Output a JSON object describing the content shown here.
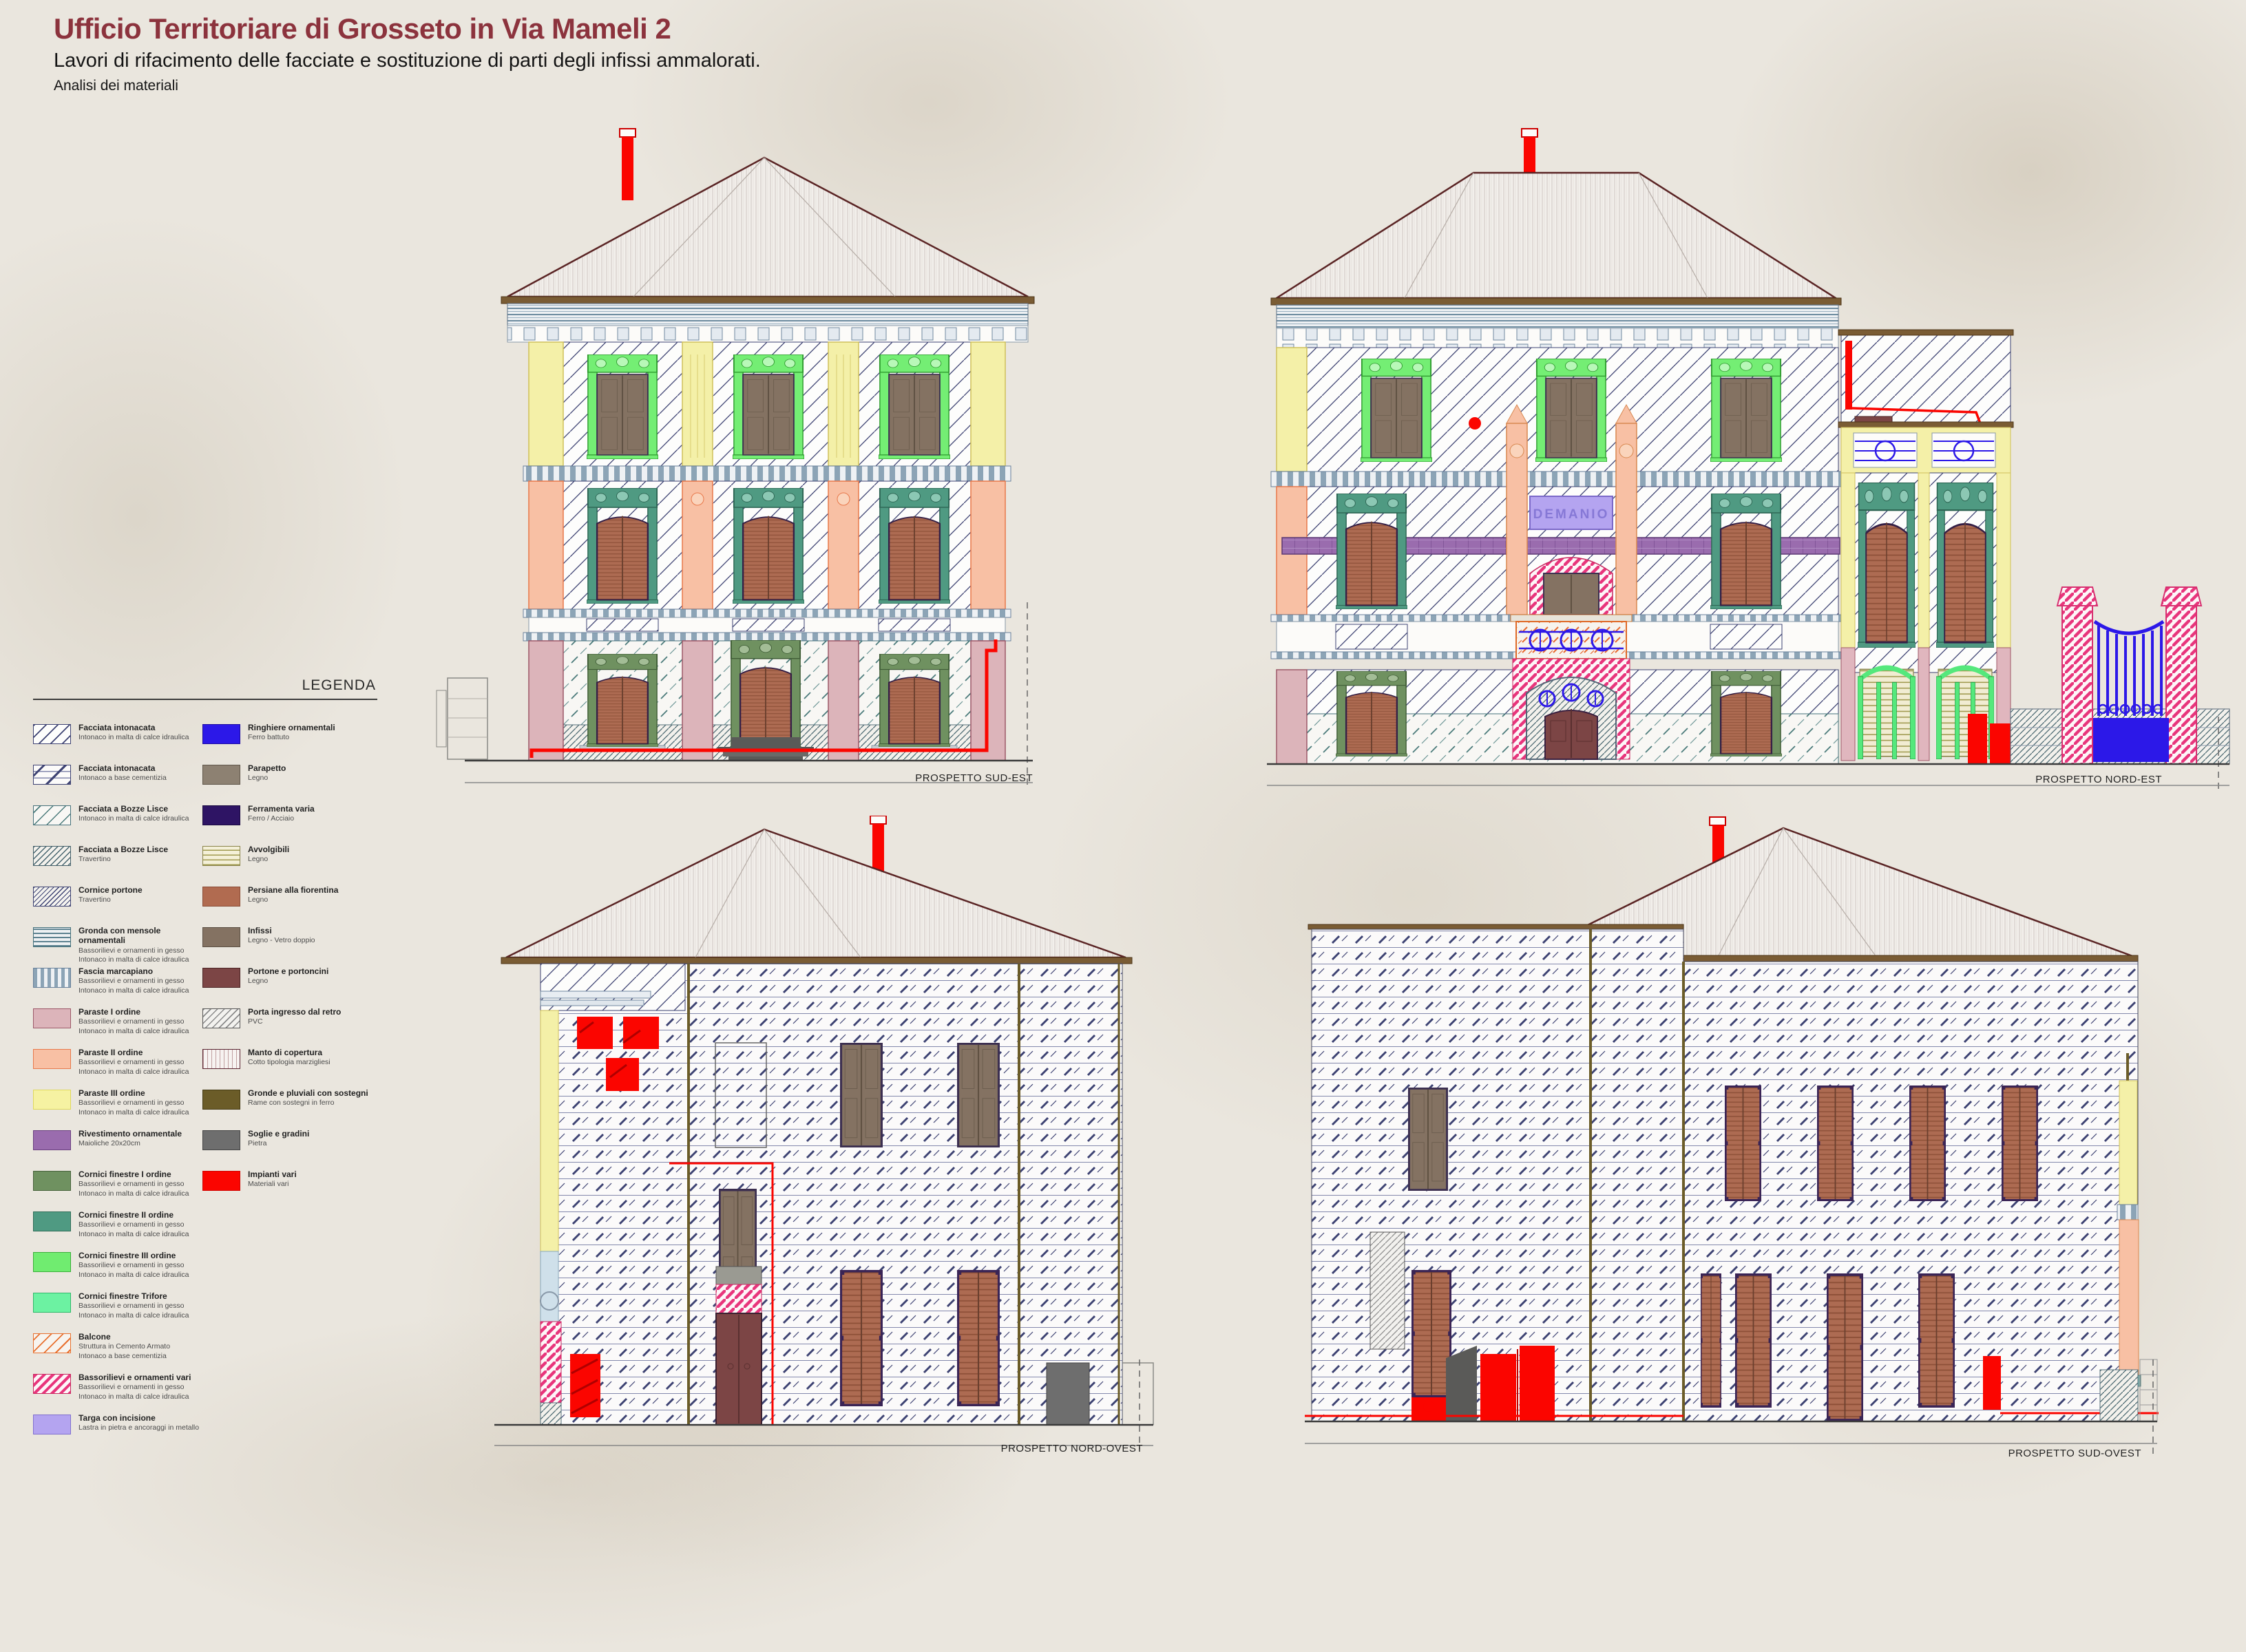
{
  "header": {
    "title": "Ufficio Territoriare di Grosseto in Via Mameli 2",
    "subtitle": "Lavori di rifacimento delle facciate e sostituzione di parti degli infissi ammalorati.",
    "note": "Analisi dei materiali"
  },
  "legend": {
    "title": "LEGENDA",
    "left": [
      {
        "title": "Facciata intonacata",
        "desc": "Intonaco in malta di calce idraulica",
        "swatch": "sw-hatch-calce"
      },
      {
        "title": "Facciata intonacata",
        "desc": "Intonaco a base cementizia",
        "swatch": "sw-hatch-cem"
      },
      {
        "title": "Facciata a Bozze Lisce",
        "desc": "Intonaco in malta di calce idraulica",
        "swatch": "sw-hatch-bozze"
      },
      {
        "title": "Facciata a Bozze Lisce",
        "desc": "Travertino",
        "swatch": "sw-hatch-trav"
      },
      {
        "title": "Cornice portone",
        "desc": "Travertino",
        "swatch": "sw-hatch-cornice"
      },
      {
        "title": "Gronda con mensole ornamentali",
        "desc": "Bassorilievi e ornamenti in gesso\nIntonaco in malta di calce idraulica",
        "swatch": "sw-gronda"
      },
      {
        "title": "Fascia marcapiano",
        "desc": "Bassorilievi e ornamenti in gesso\nIntonaco in malta di calce idraulica",
        "swatch": "sw-marcapiano"
      },
      {
        "title": "Paraste I ordine",
        "desc": "Bassorilievi e ornamenti in gesso\nIntonaco in malta di calce idraulica",
        "swatch": "sw-paraste1"
      },
      {
        "title": "Paraste II ordine",
        "desc": "Bassorilievi e ornamenti in gesso\nIntonaco in malta di calce idraulica",
        "swatch": "sw-paraste2"
      },
      {
        "title": "Paraste III ordine",
        "desc": "Bassorilievi e ornamenti in gesso\nIntonaco in malta di calce idraulica",
        "swatch": "sw-paraste3"
      },
      {
        "title": "Rivestimento ornamentale",
        "desc": "Maioliche 20x20cm",
        "swatch": "sw-maioliche"
      },
      {
        "title": "Cornici finestre I ordine",
        "desc": "Bassorilievi e ornamenti in gesso\nIntonaco in malta di calce idraulica",
        "swatch": "sw-corn1"
      },
      {
        "title": "Cornici finestre II ordine",
        "desc": "Bassorilievi e ornamenti in gesso\nIntonaco in malta di calce idraulica",
        "swatch": "sw-corn2"
      },
      {
        "title": "Cornici finestre III ordine",
        "desc": "Bassorilievi e ornamenti in gesso\nIntonaco in malta di calce idraulica",
        "swatch": "sw-corn3"
      },
      {
        "title": "Cornici finestre Trifore",
        "desc": "Bassorilievi e ornamenti in gesso\nIntonaco in malta di calce idraulica",
        "swatch": "sw-trifore"
      },
      {
        "title": "Balcone",
        "desc": "Struttura in Cemento Armato\nIntonaco a base cementizia",
        "swatch": "sw-balcone"
      },
      {
        "title": "Bassorilievi e ornamenti vari",
        "desc": "Bassorilievi e ornamenti in gesso\nIntonaco in malta di calce idraulica",
        "swatch": "sw-bassorilievi"
      },
      {
        "title": "Targa con incisione",
        "desc": "Lastra in pietra e ancoraggi in metallo",
        "swatch": "sw-targa"
      }
    ],
    "right": [
      {
        "title": "Ringhiere ornamentali",
        "desc": "Ferro battuto",
        "swatch": "sw-ringhiere"
      },
      {
        "title": "Parapetto",
        "desc": "Legno",
        "swatch": "sw-parapetto"
      },
      {
        "title": "Ferramenta varia",
        "desc": "Ferro / Acciaio",
        "swatch": "sw-ferramenta"
      },
      {
        "title": "Avvolgibili",
        "desc": "Legno",
        "swatch": "sw-avvolgibili"
      },
      {
        "title": "Persiane alla fiorentina",
        "desc": "Legno",
        "swatch": "sw-persiane"
      },
      {
        "title": "Infissi",
        "desc": "Legno - Vetro doppio",
        "swatch": "sw-infissi"
      },
      {
        "title": "Portone e portoncini",
        "desc": "Legno",
        "swatch": "sw-portone"
      },
      {
        "title": "Porta ingresso dal retro",
        "desc": "PVC",
        "swatch": "sw-porta-pvc"
      },
      {
        "title": "Manto di copertura",
        "desc": "Cotto tipologia marzigliesi",
        "swatch": "sw-manto"
      },
      {
        "title": "Gronde e pluviali con sostegni",
        "desc": "Rame con sostegni in ferro",
        "swatch": "sw-pluviali"
      },
      {
        "title": "Soglie e gradini",
        "desc": "Pietra",
        "swatch": "sw-soglie"
      },
      {
        "title": "Impianti vari",
        "desc": "Materiali vari",
        "swatch": "sw-impianti"
      }
    ]
  },
  "drawings": {
    "sud_est": {
      "caption": "PROSPETTO SUD-EST"
    },
    "nord_est": {
      "caption": "PROSPETTO NORD-EST",
      "sign": "DEMANIO"
    },
    "nord_ovest": {
      "caption": "PROSPETTO NORD-OVEST"
    },
    "sud_ovest": {
      "caption": "PROSPETTO SUD-OVEST"
    }
  },
  "colors": {
    "title_accent": "#8c333d",
    "impianti_red": "#fb0500",
    "ringhiere_blue": "#2c18e8",
    "persiane": "#b16b50",
    "infissi": "#847262",
    "portone": "#7c4545",
    "maioliche": "#9a6cae",
    "targa": "#b4a4f0",
    "paper": "#eae6de"
  }
}
